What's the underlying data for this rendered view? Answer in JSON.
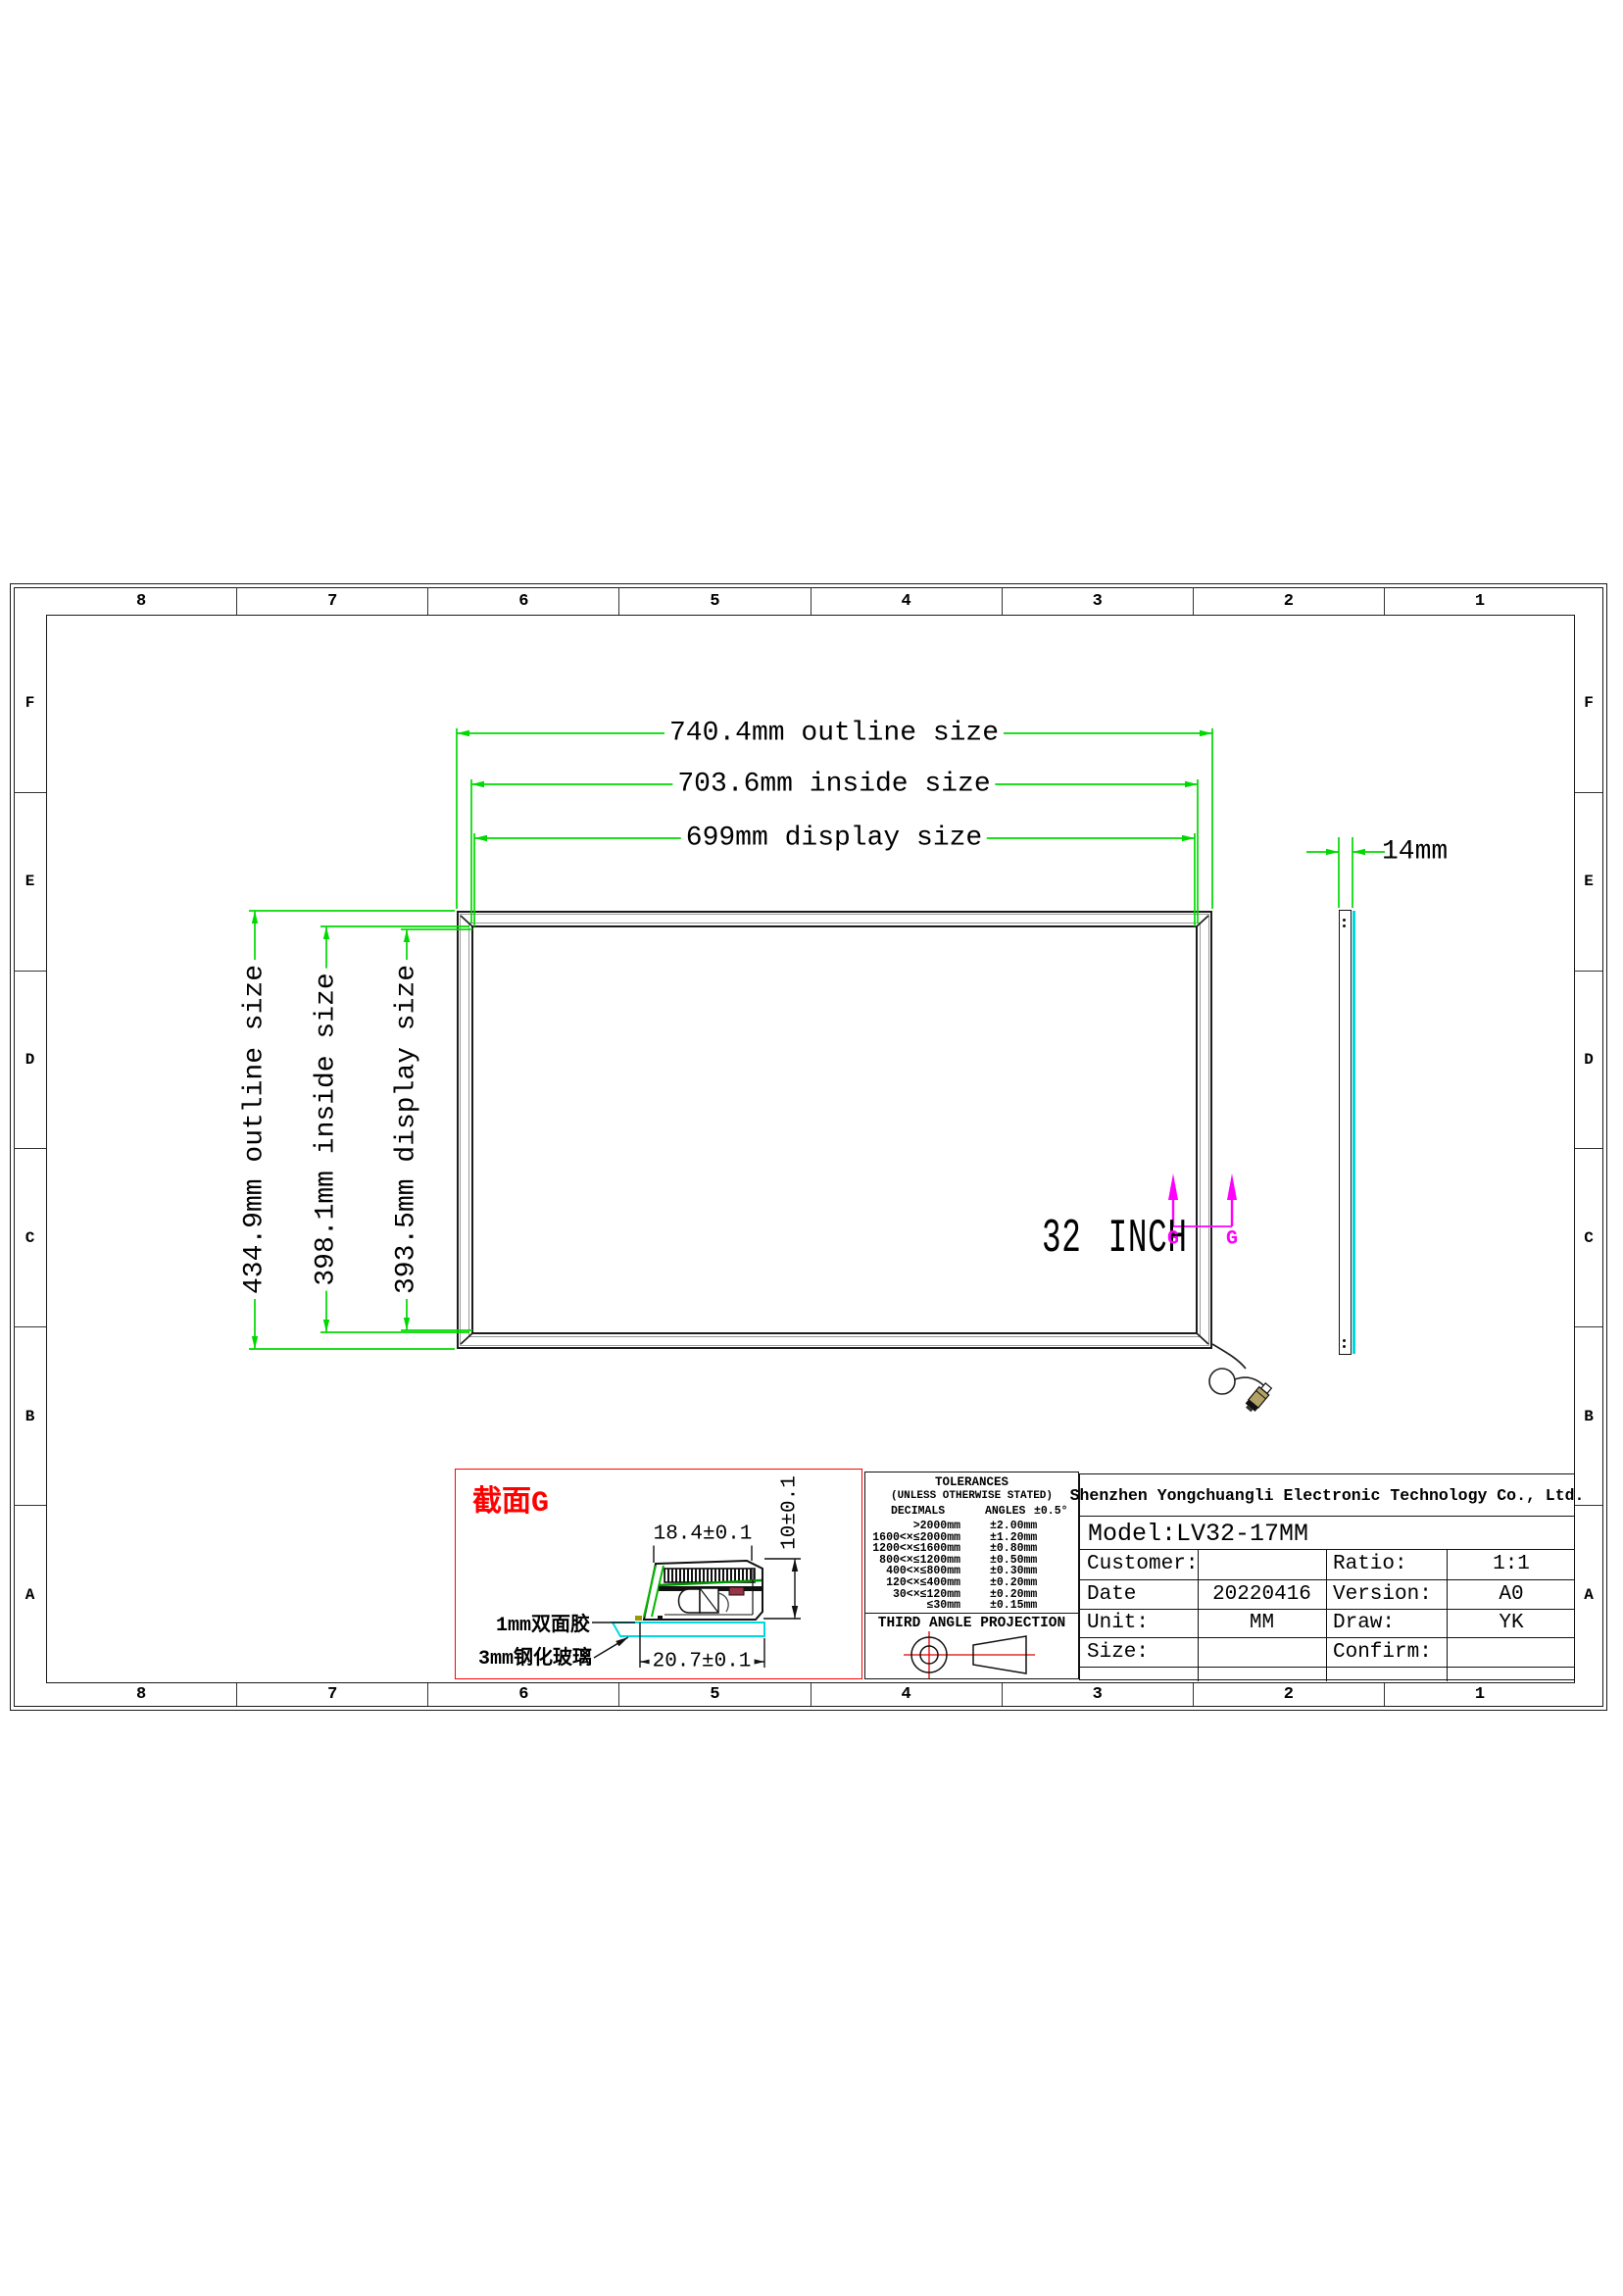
{
  "sheet": {
    "grid_columns": [
      "8",
      "7",
      "6",
      "5",
      "4",
      "3",
      "2",
      "1"
    ],
    "grid_rows": [
      "F",
      "E",
      "D",
      "C",
      "B",
      "A"
    ]
  },
  "front_view": {
    "dim_outline": "740.4mm outline size",
    "dim_inside": "703.6mm inside size",
    "dim_display": "699mm display size",
    "dim_outline_v": "434.9mm outline size",
    "dim_inside_v": "398.1mm inside size",
    "dim_display_v": "393.5mm display size",
    "size_label": "32 INCH",
    "section_letter": "G"
  },
  "side_view": {
    "thickness": "14mm"
  },
  "section_detail": {
    "title": "截面G",
    "dim_top": "18.4±0.1",
    "dim_height": "10±0.1",
    "dim_bottom": "20.7±0.1",
    "tape_label": "1mm双面胶",
    "glass_label": "3mm钢化玻璃"
  },
  "tolerances": {
    "title": "TOLERANCES",
    "subtitle": "(UNLESS OTHERWISE STATED)",
    "col_decimals": "DECIMALS",
    "col_angles": "ANGLES",
    "angles_value": "±0.5°",
    "rows": [
      {
        "range": ">2000mm",
        "tol": "±2.00mm"
      },
      {
        "range": "1600<×≤2000mm",
        "tol": "±1.20mm"
      },
      {
        "range": "1200<×≤1600mm",
        "tol": "±0.80mm"
      },
      {
        "range": "800<×≤1200mm",
        "tol": "±0.50mm"
      },
      {
        "range": "400<×≤800mm",
        "tol": "±0.30mm"
      },
      {
        "range": "120<×≤400mm",
        "tol": "±0.20mm"
      },
      {
        "range": "30<×≤120mm",
        "tol": "±0.20mm"
      },
      {
        "range": "≤30mm",
        "tol": "±0.15mm"
      }
    ],
    "projection": "THIRD ANGLE PROJECTION"
  },
  "title_block": {
    "company": "Shenzhen Yongchuangli Electronic Technology Co., Ltd.",
    "model": "Model:LV32-17MM",
    "fields": [
      {
        "label": "Customer:",
        "value": ""
      },
      {
        "label": "Ratio:",
        "value": "1:1"
      },
      {
        "label": "Date",
        "value": "20220416"
      },
      {
        "label": "Version:",
        "value": "A0"
      },
      {
        "label": "Unit:",
        "value": "MM"
      },
      {
        "label": "Draw:",
        "value": "YK"
      },
      {
        "label": "Size:",
        "value": ""
      },
      {
        "label": "Confirm:",
        "value": ""
      }
    ]
  },
  "colors": {
    "dimension_green": "#00d900",
    "glass_cyan": "#00d8e0",
    "section_magenta": "#ff00ff",
    "highlight_red": "#ff0000"
  }
}
